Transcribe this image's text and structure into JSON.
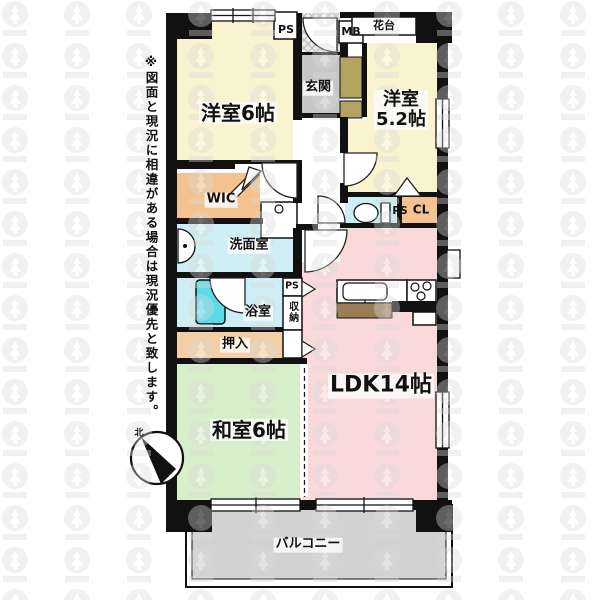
{
  "disclaimer": "※図面と現況に相違がある場合は現況優先と致します。",
  "compass": {
    "north_label": "北"
  },
  "labels": {
    "western6": "洋室6帖",
    "western52_l1": "洋室",
    "western52_l2": "5.2帖",
    "ldk": "LDK14帖",
    "japanese6": "和室6帖",
    "balcony": "バルコニー",
    "genkan": "玄関",
    "wic": "WIC",
    "washroom": "洗面室",
    "bathroom": "浴室",
    "oshiire": "押入",
    "closet_cl": "CL",
    "shunou": "収納",
    "ps_top": "PS",
    "ps_toilet": "PS",
    "ps_kitchen": "PS",
    "mb": "MB",
    "hanadai": "花台"
  },
  "colors": {
    "wall": "#111111",
    "western_room": "#f9f3cf",
    "ldk": "#f9d9da",
    "japanese_room": "#d7eecb",
    "closet": "#f3c28f",
    "oshiire_fill": "#f3cfa3",
    "wet_area": "#cdeef5",
    "bathtub": "#5ed9e8",
    "genkan_floor": "#c6c6c6",
    "shoe_cabinet": "#b2a35e",
    "balcony_fill": "#d2d2d2",
    "kitchen_counter": "#9b7d55"
  }
}
